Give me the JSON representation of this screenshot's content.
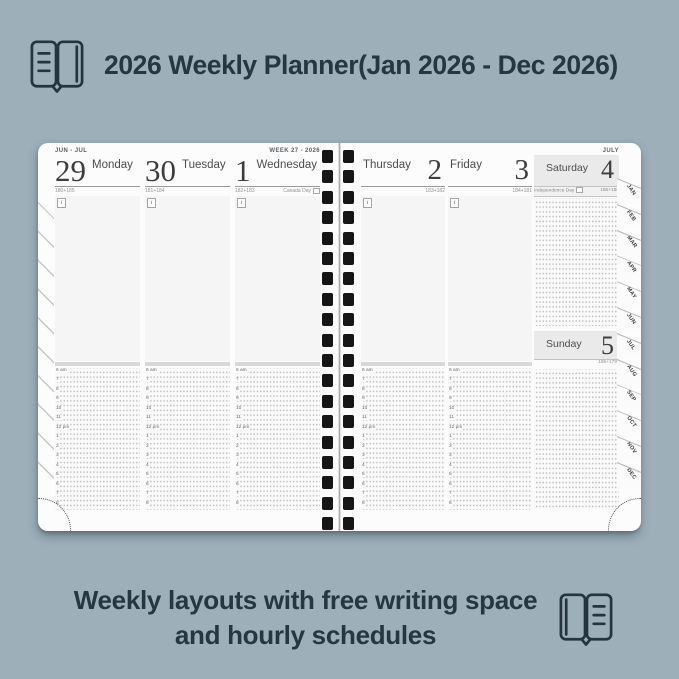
{
  "colors": {
    "background": "#9DAFB9",
    "text_dark": "#263740",
    "page": "#FCFCFC",
    "notes_area": "#F5F5F6",
    "weekend_header": "#EAEAEA",
    "binding_hole": "#161616"
  },
  "header": {
    "title": "2026 Weekly Planner(Jan 2026 - Dec 2026)",
    "icon": "open-book-icon"
  },
  "footer": {
    "line1": "Weekly layouts with free writing space",
    "line2": "and hourly schedules",
    "icon": "open-book-icon"
  },
  "planner": {
    "info_icon_label": "i",
    "left_page": {
      "month_range_label": "JUN - JUL",
      "week_label": "WEEK 27 - 2026",
      "days": [
        {
          "date": "29",
          "name": "Monday",
          "ordinal": "180+185",
          "holiday": ""
        },
        {
          "date": "30",
          "name": "Tuesday",
          "ordinal": "181+184",
          "holiday": ""
        },
        {
          "date": "1",
          "name": "Wednesday",
          "ordinal": "182+183",
          "holiday": "Canada Day"
        }
      ]
    },
    "right_page": {
      "month_label": "JULY",
      "days": [
        {
          "date": "2",
          "name": "Thursday",
          "ordinal": "183+182",
          "holiday": ""
        },
        {
          "date": "3",
          "name": "Friday",
          "ordinal": "184+181",
          "holiday": ""
        }
      ],
      "weekend": [
        {
          "date": "4",
          "name": "Saturday",
          "ordinal": "185+180",
          "holiday": "Independence Day"
        },
        {
          "date": "5",
          "name": "Sunday",
          "ordinal": "186+179",
          "holiday": ""
        }
      ],
      "month_tabs": [
        "JAN",
        "FEB",
        "MAR",
        "APR",
        "MAY",
        "JUN",
        "JUL",
        "AUG",
        "SEP",
        "OCT",
        "NOV",
        "DEC"
      ]
    },
    "hours": [
      "6 am",
      "7",
      "8",
      "9",
      "10",
      "11",
      "12 pm",
      "1",
      "2",
      "3",
      "4",
      "5",
      "6",
      "7",
      "8"
    ]
  }
}
